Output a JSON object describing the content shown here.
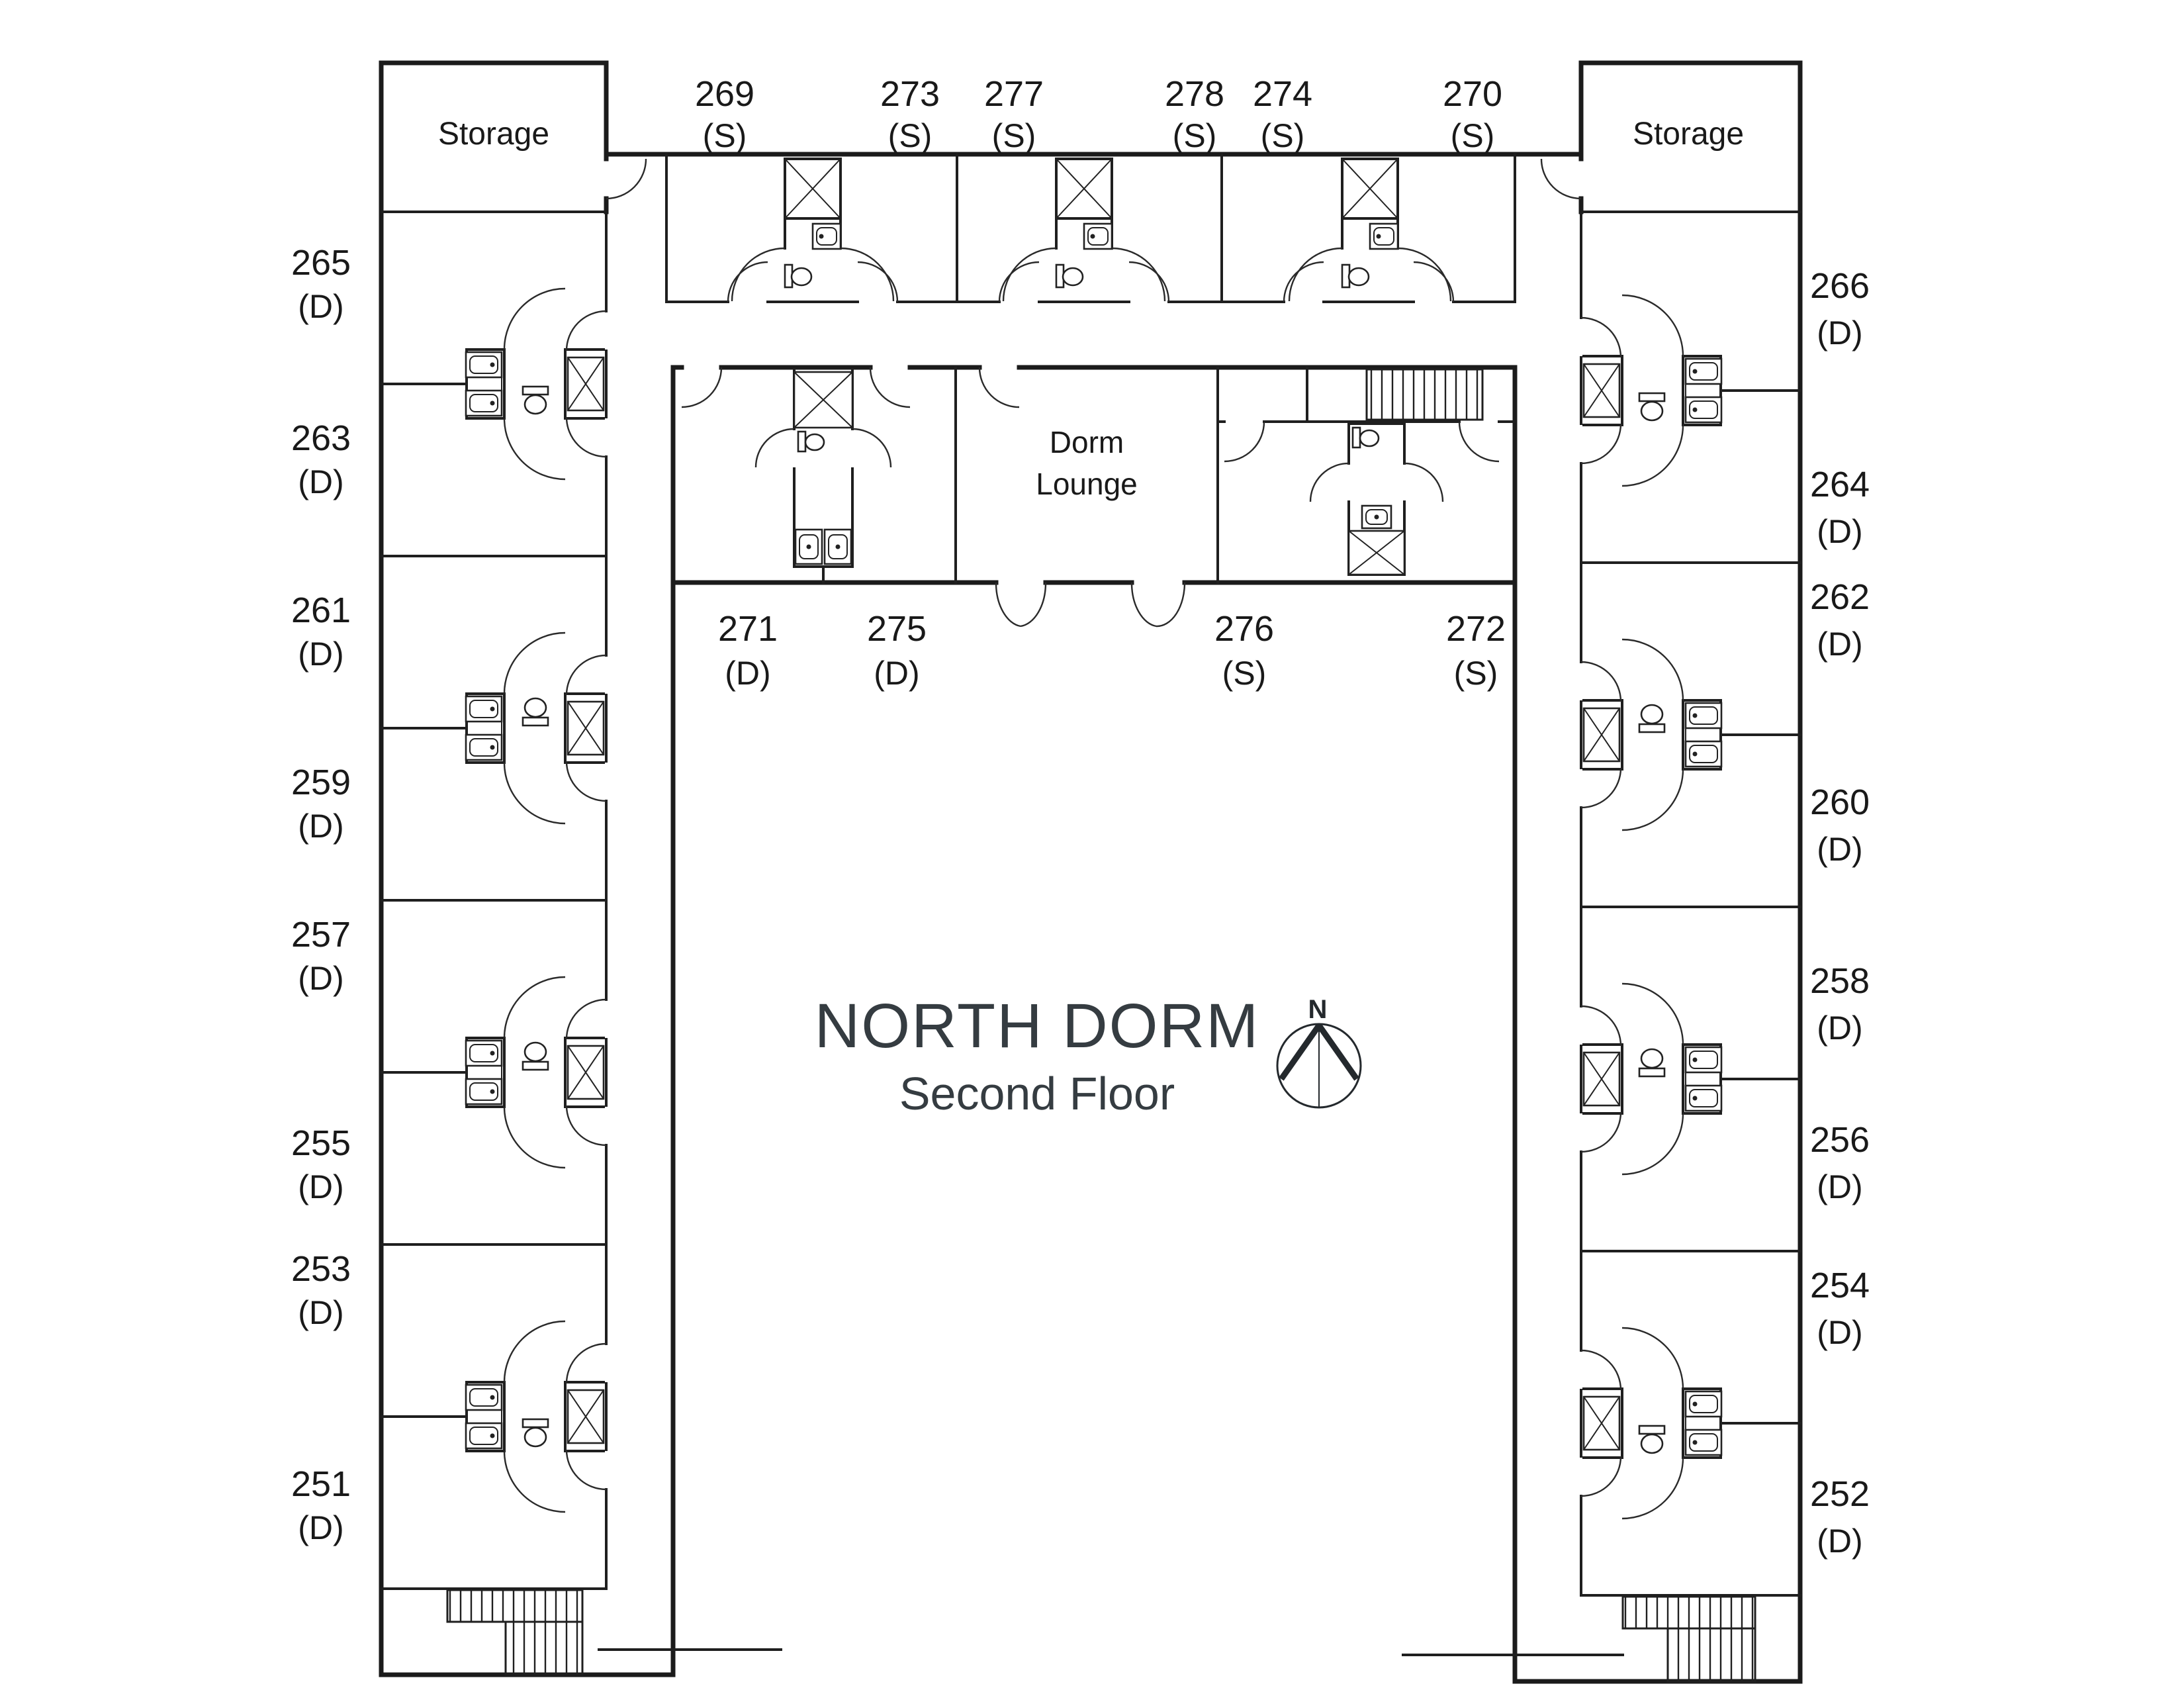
{
  "title": {
    "main": "NORTH DORM",
    "subtitle": "Second Floor"
  },
  "compass": {
    "north": "N"
  },
  "labels": {
    "storage_left": "Storage",
    "storage_right": "Storage",
    "lounge_line1": "Dorm",
    "lounge_line2": "Lounge"
  },
  "rooms": {
    "top": [
      {
        "number": "269",
        "type": "(S)"
      },
      {
        "number": "273",
        "type": "(S)"
      },
      {
        "number": "277",
        "type": "(S)"
      },
      {
        "number": "278",
        "type": "(S)"
      },
      {
        "number": "274",
        "type": "(S)"
      },
      {
        "number": "270",
        "type": "(S)"
      }
    ],
    "middle": [
      {
        "number": "271",
        "type": "(D)"
      },
      {
        "number": "275",
        "type": "(D)"
      },
      {
        "number": "276",
        "type": "(S)"
      },
      {
        "number": "272",
        "type": "(S)"
      }
    ],
    "left": [
      {
        "number": "265",
        "type": "(D)"
      },
      {
        "number": "263",
        "type": "(D)"
      },
      {
        "number": "261",
        "type": "(D)"
      },
      {
        "number": "259",
        "type": "(D)"
      },
      {
        "number": "257",
        "type": "(D)"
      },
      {
        "number": "255",
        "type": "(D)"
      },
      {
        "number": "253",
        "type": "(D)"
      },
      {
        "number": "251",
        "type": "(D)"
      }
    ],
    "right": [
      {
        "number": "266",
        "type": "(D)"
      },
      {
        "number": "264",
        "type": "(D)"
      },
      {
        "number": "262",
        "type": "(D)"
      },
      {
        "number": "260",
        "type": "(D)"
      },
      {
        "number": "258",
        "type": "(D)"
      },
      {
        "number": "256",
        "type": "(D)"
      },
      {
        "number": "254",
        "type": "(D)"
      },
      {
        "number": "252",
        "type": "(D)"
      }
    ]
  }
}
